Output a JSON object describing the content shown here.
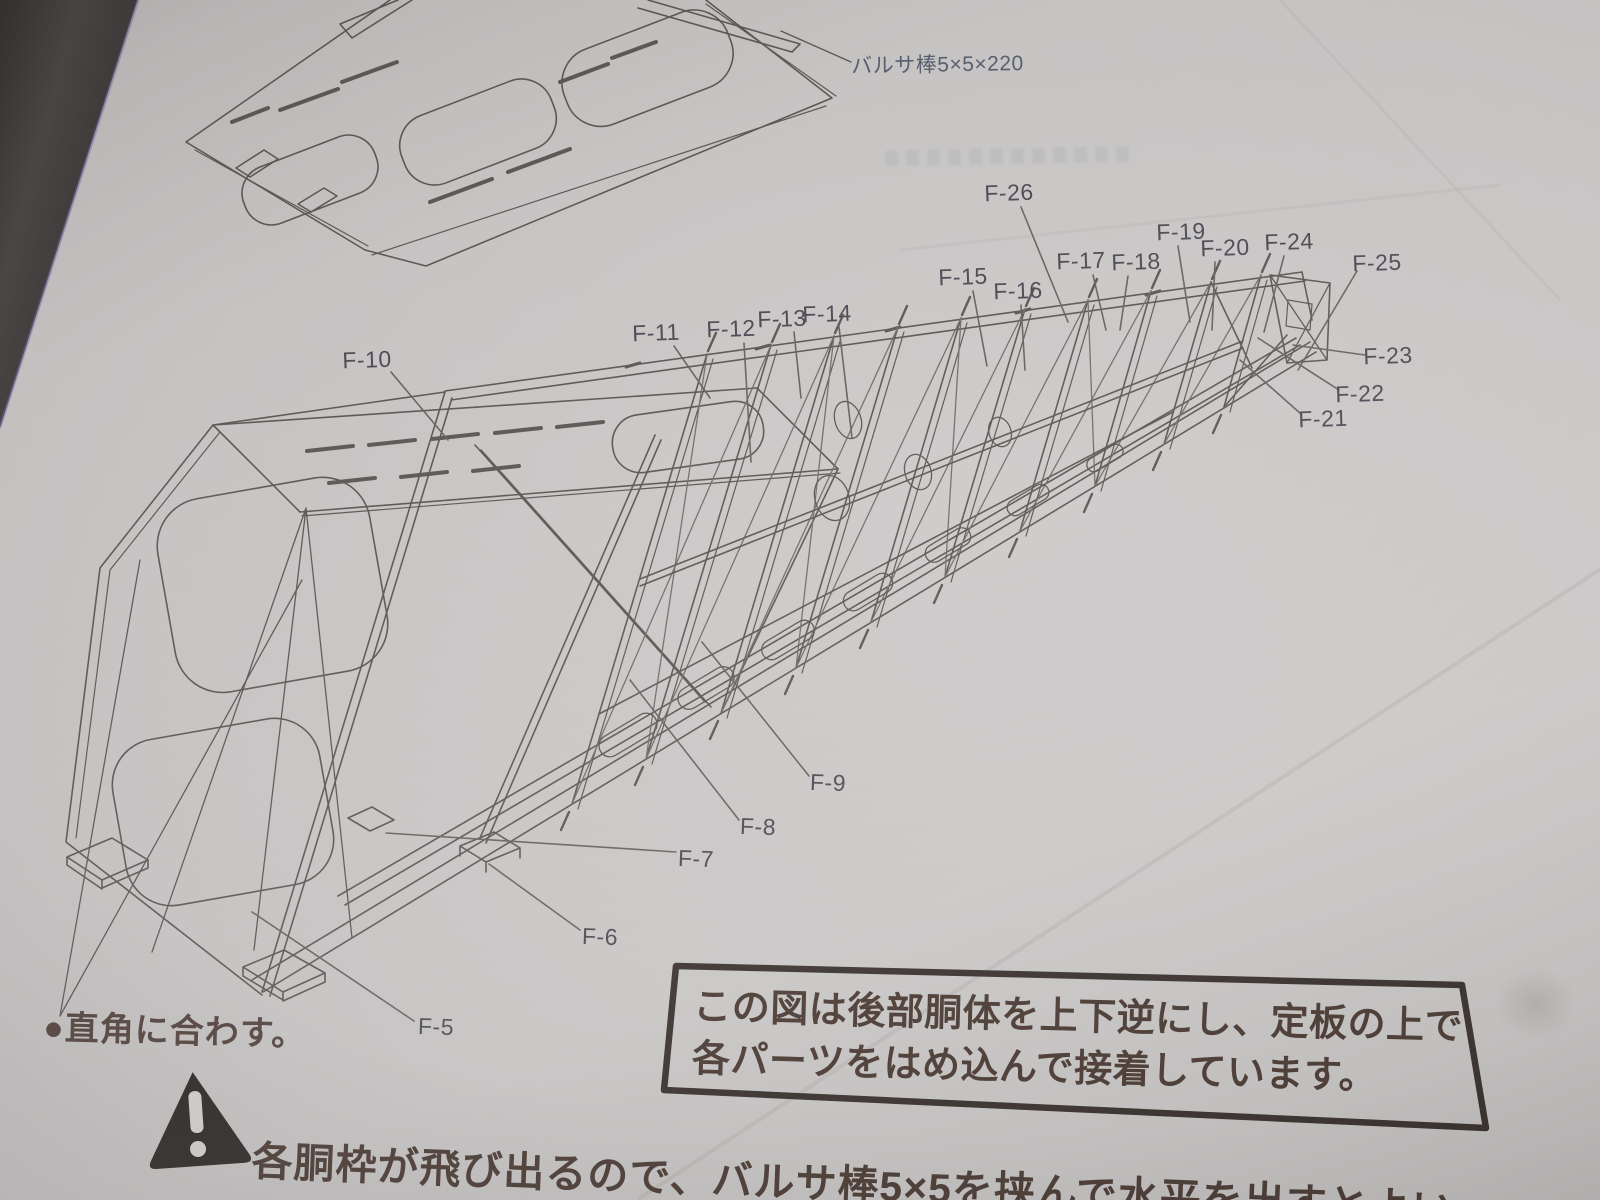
{
  "notes": {
    "balsa_label": "バルサ棒5×5×220",
    "right_angle_note": "●直角に合わす。",
    "box_note_line1": "この図は後部胴体を上下逆にし、定板の上で",
    "box_note_line2": "各パーツをはめ込んで接着しています。",
    "warning_note": "各胴枠が飛び出るので、バルサ棒5×5を挟んで水平を出すとよい"
  },
  "icons": {
    "warning": "alert-triangle-icon"
  },
  "colors": {
    "paper": "#c9c7c6",
    "ink": "#5f5a57",
    "label_ink": "#4f4c57",
    "note_ink": "#4a3a33",
    "box_border": "#38312d",
    "table": "#413f3e"
  },
  "part_labels": [
    {
      "text": "F-5",
      "x": 436,
      "y": 1027,
      "rot": 2,
      "leader": [
        414,
        1021,
        252,
        912
      ]
    },
    {
      "text": "F-6",
      "x": 600,
      "y": 937,
      "rot": 2,
      "leader": [
        580,
        930,
        489,
        864
      ]
    },
    {
      "text": "F-7",
      "x": 696,
      "y": 859,
      "rot": 2,
      "leader": [
        676,
        852,
        386,
        833
      ]
    },
    {
      "text": "F-8",
      "x": 758,
      "y": 827,
      "rot": 2,
      "leader": [
        739,
        820,
        630,
        680
      ]
    },
    {
      "text": "F-9",
      "x": 828,
      "y": 783,
      "rot": 2,
      "leader": [
        809,
        776,
        702,
        642
      ]
    },
    {
      "text": "F-10",
      "x": 367,
      "y": 360,
      "rot": -2,
      "leader": [
        391,
        372,
        448,
        440
      ]
    },
    {
      "text": "F-11",
      "x": 656,
      "y": 333,
      "rot": -2,
      "leader": [
        674,
        346,
        710,
        398
      ]
    },
    {
      "text": "F-12",
      "x": 731,
      "y": 329,
      "rot": -2,
      "leader": [
        744,
        343,
        751,
        462
      ]
    },
    {
      "text": "F-13",
      "x": 782,
      "y": 319,
      "rot": -2,
      "leader": [
        794,
        332,
        801,
        398
      ]
    },
    {
      "text": "F-14",
      "x": 827,
      "y": 314,
      "rot": -2,
      "leader": [
        839,
        327,
        852,
        438
      ]
    },
    {
      "text": "F-15",
      "x": 963,
      "y": 277,
      "rot": -2,
      "leader": [
        973,
        291,
        987,
        366
      ]
    },
    {
      "text": "F-16",
      "x": 1018,
      "y": 291,
      "rot": -2,
      "leader": [
        1021,
        305,
        1025,
        370
      ]
    },
    {
      "text": "F-17",
      "x": 1081,
      "y": 261,
      "rot": -2,
      "leader": [
        1093,
        275,
        1106,
        330
      ]
    },
    {
      "text": "F-18",
      "x": 1136,
      "y": 262,
      "rot": -2,
      "leader": [
        1128,
        276,
        1120,
        330
      ]
    },
    {
      "text": "F-19",
      "x": 1181,
      "y": 232,
      "rot": -2,
      "leader": [
        1178,
        246,
        1190,
        322
      ]
    },
    {
      "text": "F-20",
      "x": 1225,
      "y": 248,
      "rot": -2,
      "leader": [
        1215,
        262,
        1212,
        330
      ]
    },
    {
      "text": "F-21",
      "x": 1323,
      "y": 419,
      "rot": -2,
      "leader": [
        1301,
        414,
        1240,
        360
      ]
    },
    {
      "text": "F-22",
      "x": 1360,
      "y": 394,
      "rot": -2,
      "leader": [
        1339,
        390,
        1258,
        338
      ]
    },
    {
      "text": "F-23",
      "x": 1388,
      "y": 356,
      "rot": -2,
      "leader": [
        1365,
        355,
        1293,
        345
      ]
    },
    {
      "text": "F-24",
      "x": 1289,
      "y": 242,
      "rot": -2,
      "leader": [
        1284,
        256,
        1264,
        332
      ]
    },
    {
      "text": "F-25",
      "x": 1377,
      "y": 263,
      "rot": -2,
      "leader": [
        1357,
        271,
        1298,
        370
      ]
    },
    {
      "text": "F-26",
      "x": 1009,
      "y": 193,
      "rot": -2,
      "leader": [
        1021,
        207,
        1068,
        322
      ]
    }
  ]
}
